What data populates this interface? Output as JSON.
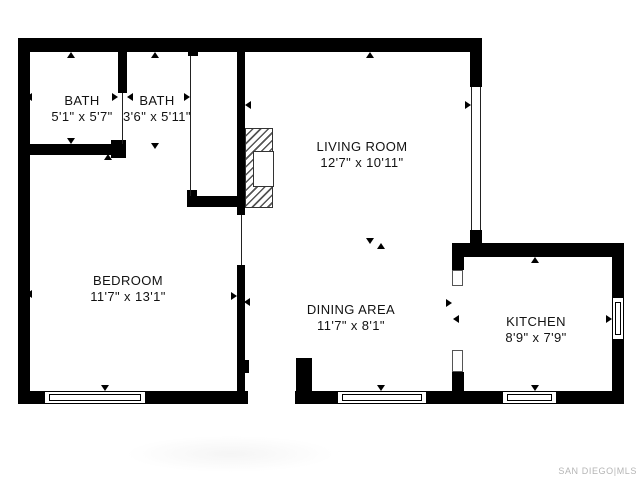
{
  "watermark": "SAN DIEGO|MLS",
  "colors": {
    "wall": "#000000",
    "text": "#121212",
    "watermark": "#b5b5b5"
  },
  "rooms": [
    {
      "id": "bath-1",
      "label": "BATH",
      "dims": "5'1\" x 5'7\"",
      "cx": 82,
      "cy": 109
    },
    {
      "id": "bath-2",
      "label": "BATH",
      "dims": "3'6\" x 5'11\"",
      "cx": 157,
      "cy": 109
    },
    {
      "id": "living-room",
      "label": "LIVING ROOM",
      "dims": "12'7\" x 10'11\"",
      "cx": 362,
      "cy": 155
    },
    {
      "id": "bedroom",
      "label": "BEDROOM",
      "dims": "11'7\" x 13'1\"",
      "cx": 128,
      "cy": 289
    },
    {
      "id": "dining-area",
      "label": "DINING AREA",
      "dims": "11'7\" x 8'1\"",
      "cx": 351,
      "cy": 318
    },
    {
      "id": "kitchen",
      "label": "KITCHEN",
      "dims": "8'9\" x 7'9\"",
      "cx": 536,
      "cy": 330
    }
  ],
  "geometry": {
    "walls": [
      [
        18,
        38,
        464,
        14
      ],
      [
        18,
        38,
        12,
        366
      ],
      [
        18,
        391,
        230,
        13
      ],
      [
        237,
        360,
        12,
        13
      ],
      [
        470,
        38,
        12,
        49
      ],
      [
        470,
        230,
        12,
        15
      ],
      [
        453,
        243,
        171,
        14
      ],
      [
        612,
        243,
        12,
        161
      ],
      [
        295,
        391,
        329,
        13
      ],
      [
        296,
        358,
        16,
        46
      ],
      [
        237,
        265,
        8,
        139
      ],
      [
        237,
        52,
        8,
        163
      ],
      [
        188,
        196,
        57,
        11
      ],
      [
        187,
        190,
        10,
        17
      ],
      [
        118,
        52,
        9,
        41
      ],
      [
        18,
        144,
        95,
        11
      ],
      [
        111,
        140,
        15,
        18
      ],
      [
        188,
        52,
        10,
        4
      ],
      [
        452,
        243,
        12,
        27
      ],
      [
        452,
        372,
        12,
        32
      ]
    ],
    "thin_lines": [
      [
        122,
        93,
        1,
        51
      ],
      [
        190,
        56,
        1,
        140
      ],
      [
        241,
        215,
        1,
        50
      ],
      [
        471,
        87,
        1,
        143
      ],
      [
        480,
        87,
        1,
        143
      ]
    ],
    "door_casings": [
      [
        452,
        270,
        11,
        16
      ],
      [
        452,
        350,
        11,
        22
      ]
    ],
    "windows": [
      {
        "x": 44,
        "y": 391,
        "w": 102,
        "h": 13,
        "o": "h"
      },
      {
        "x": 337,
        "y": 391,
        "w": 90,
        "h": 13,
        "o": "h"
      },
      {
        "x": 502,
        "y": 391,
        "w": 55,
        "h": 13,
        "o": "h"
      },
      {
        "x": 612,
        "y": 297,
        "w": 12,
        "h": 43,
        "o": "v"
      }
    ],
    "fireplace": {
      "x": 245,
      "y": 128,
      "w": 28,
      "h": 80,
      "ix": 7,
      "iy": 22,
      "iw": 19,
      "ih": 34
    },
    "arrows": [
      {
        "d": "up",
        "x": 71,
        "y": 55
      },
      {
        "d": "down",
        "x": 71,
        "y": 141
      },
      {
        "d": "left",
        "x": 29,
        "y": 97
      },
      {
        "d": "right",
        "x": 115,
        "y": 97
      },
      {
        "d": "up",
        "x": 155,
        "y": 55
      },
      {
        "d": "down",
        "x": 155,
        "y": 146
      },
      {
        "d": "left",
        "x": 130,
        "y": 97
      },
      {
        "d": "right",
        "x": 187,
        "y": 97
      },
      {
        "d": "up",
        "x": 370,
        "y": 55
      },
      {
        "d": "down",
        "x": 370,
        "y": 241
      },
      {
        "d": "left",
        "x": 248,
        "y": 105
      },
      {
        "d": "right",
        "x": 468,
        "y": 105
      },
      {
        "d": "up",
        "x": 108,
        "y": 157
      },
      {
        "d": "down",
        "x": 105,
        "y": 388
      },
      {
        "d": "left",
        "x": 29,
        "y": 294
      },
      {
        "d": "right",
        "x": 234,
        "y": 296
      },
      {
        "d": "up",
        "x": 381,
        "y": 246
      },
      {
        "d": "down",
        "x": 381,
        "y": 388
      },
      {
        "d": "left",
        "x": 247,
        "y": 302
      },
      {
        "d": "right",
        "x": 449,
        "y": 303
      },
      {
        "d": "up",
        "x": 535,
        "y": 260
      },
      {
        "d": "down",
        "x": 535,
        "y": 388
      },
      {
        "d": "left",
        "x": 456,
        "y": 319
      },
      {
        "d": "right",
        "x": 609,
        "y": 319
      }
    ]
  }
}
